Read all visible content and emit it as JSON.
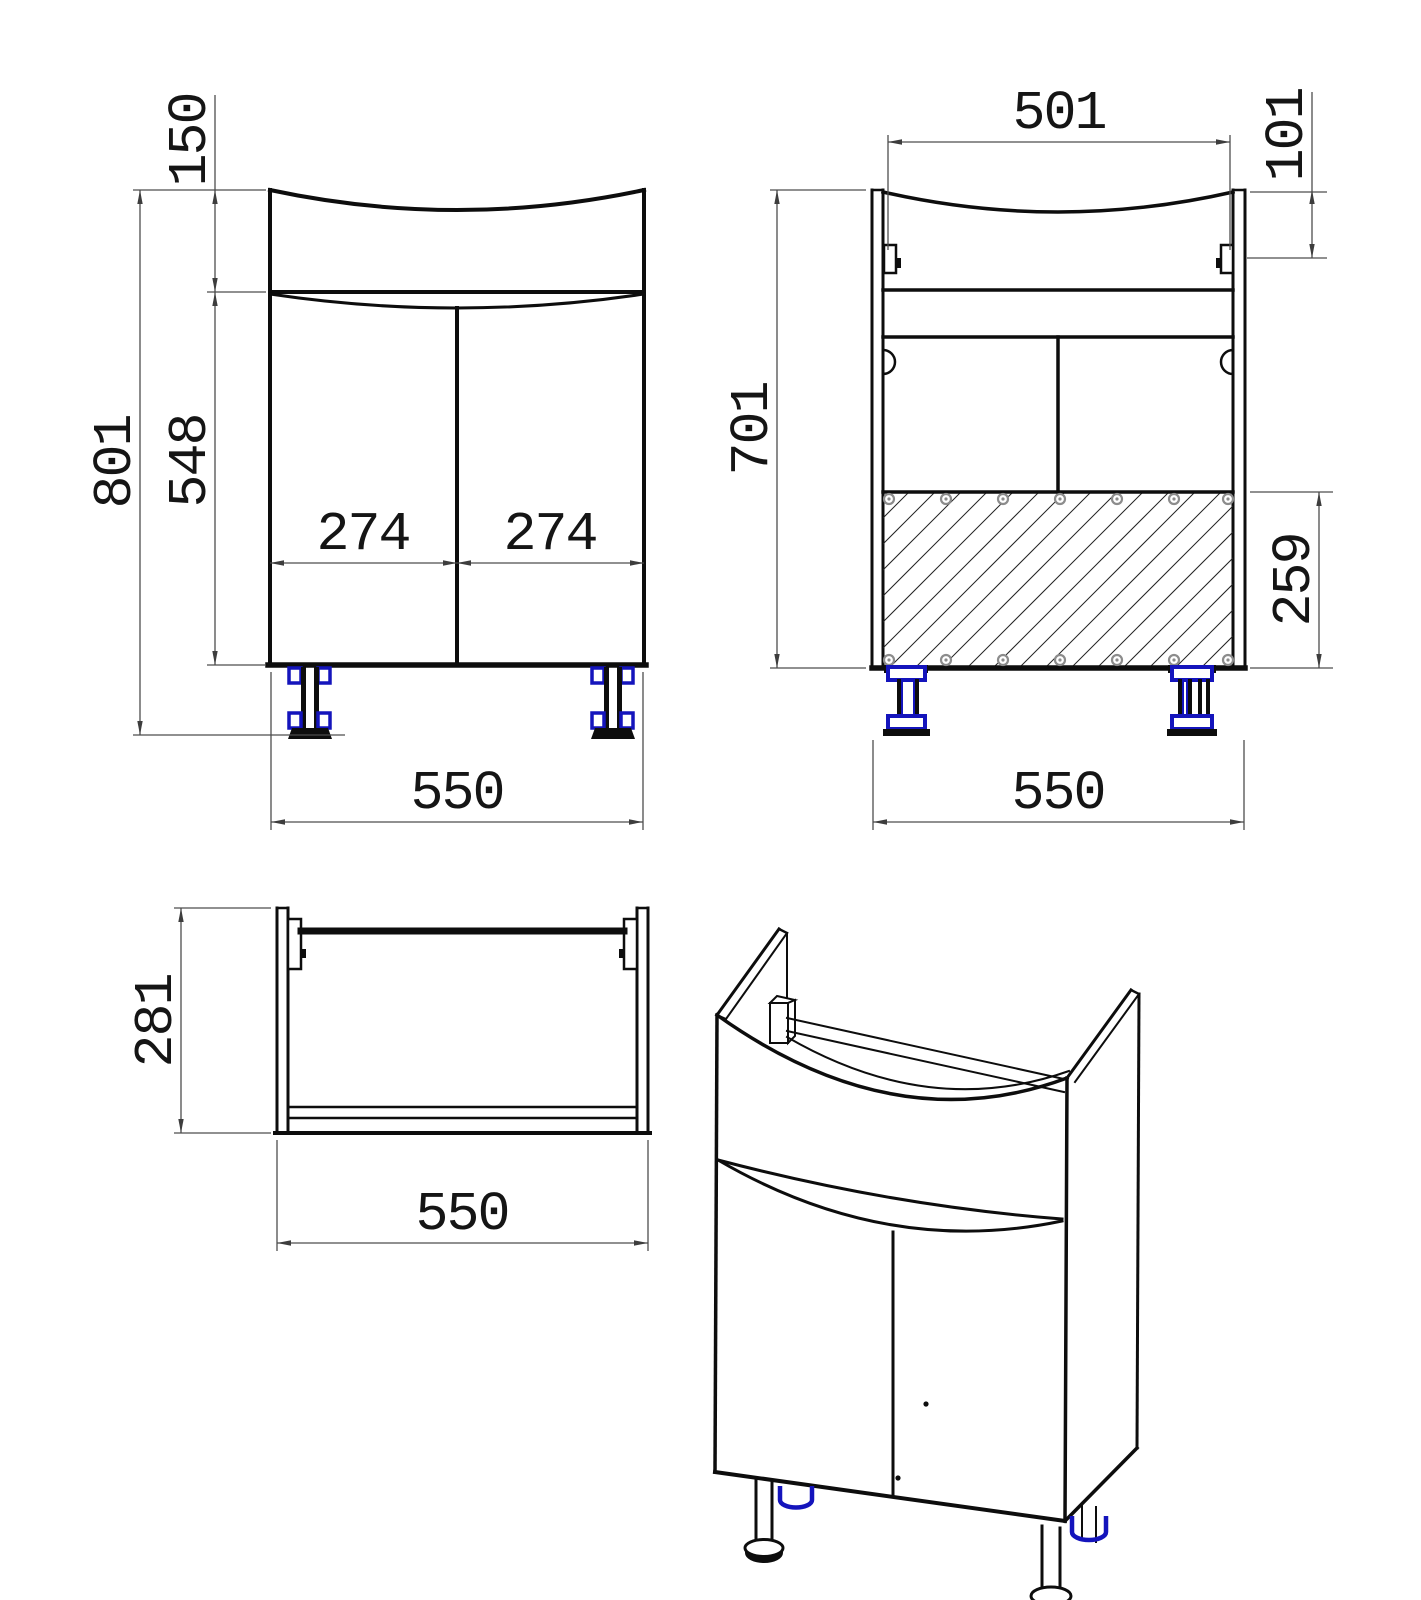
{
  "dimensions": {
    "front": {
      "top_section_height": "150",
      "overall_height": "801",
      "door_section_height": "548",
      "left_door_width": "274",
      "right_door_width": "274",
      "overall_width": "550"
    },
    "back": {
      "top_inner_width": "501",
      "bracket_offset": "101",
      "carcass_height": "701",
      "back_panel_height": "259",
      "overall_width": "550"
    },
    "top": {
      "depth": "281",
      "overall_width": "550"
    }
  },
  "colors": {
    "outline": "#0d0d0d",
    "dimension_line": "#4d4d4d",
    "leg_accent_blue": "#1414bc",
    "screw_gray": "#8c8c8c",
    "background": "#ffffff"
  }
}
